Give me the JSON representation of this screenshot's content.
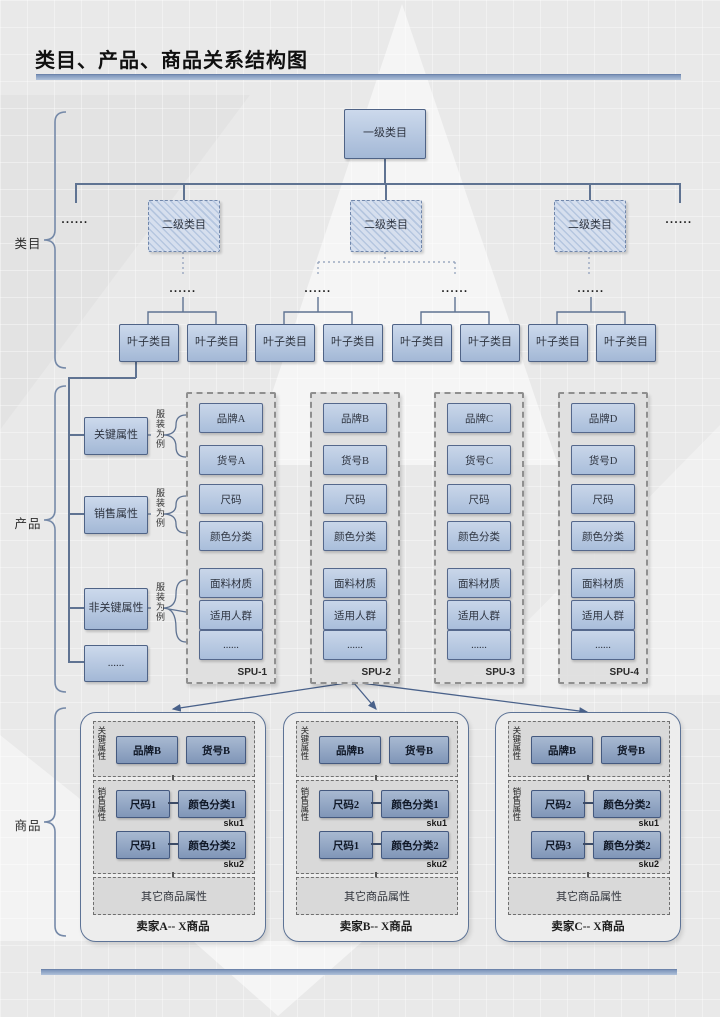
{
  "title": "类目、产品、商品关系结构图",
  "ellipsis": "......",
  "category": {
    "label": "类目",
    "root": "一级类目",
    "level2": [
      "二级类目",
      "二级类目",
      "二级类目"
    ],
    "leaves": [
      "叶子类目",
      "叶子类目",
      "叶子类目",
      "叶子类目",
      "叶子类目",
      "叶子类目",
      "叶子类目",
      "叶子类目"
    ]
  },
  "product": {
    "label": "产品",
    "example_note": "服装为例",
    "attr_groups": [
      {
        "label": "关键属性"
      },
      {
        "label": "销售属性"
      },
      {
        "label": "非关键属性"
      },
      {
        "label": "......"
      }
    ],
    "spus": [
      {
        "name": "SPU-1",
        "items": [
          "品牌A",
          "货号A",
          "尺码",
          "颜色分类",
          "面料材质",
          "适用人群",
          "......"
        ]
      },
      {
        "name": "SPU-2",
        "items": [
          "品牌B",
          "货号B",
          "尺码",
          "颜色分类",
          "面料材质",
          "适用人群",
          "......"
        ]
      },
      {
        "name": "SPU-3",
        "items": [
          "品牌C",
          "货号C",
          "尺码",
          "颜色分类",
          "面料材质",
          "适用人群",
          "......"
        ]
      },
      {
        "name": "SPU-4",
        "items": [
          "品牌D",
          "货号D",
          "尺码",
          "颜色分类",
          "面料材质",
          "适用人群",
          "......"
        ]
      }
    ]
  },
  "goods": {
    "label": "商品",
    "sellers": [
      {
        "caption": "卖家A-- X商品",
        "key_label": "关键属性",
        "brand": "品牌B",
        "item_no": "货号B",
        "sales_label": "销售属性",
        "skus": [
          {
            "size": "尺码1",
            "color": "颜色分类1",
            "tag": "sku1"
          },
          {
            "size": "尺码1",
            "color": "颜色分类2",
            "tag": "sku2"
          }
        ],
        "other": "其它商品属性"
      },
      {
        "caption": "卖家B-- X商品",
        "key_label": "关键属性",
        "brand": "品牌B",
        "item_no": "货号B",
        "sales_label": "销售属性",
        "skus": [
          {
            "size": "尺码2",
            "color": "颜色分类1",
            "tag": "sku1"
          },
          {
            "size": "尺码1",
            "color": "颜色分类2",
            "tag": "sku2"
          }
        ],
        "other": "其它商品属性"
      },
      {
        "caption": "卖家C-- X商品",
        "key_label": "关键属性",
        "brand": "品牌B",
        "item_no": "货号B",
        "sales_label": "销售属性",
        "skus": [
          {
            "size": "尺码2",
            "color": "颜色分类2",
            "tag": "sku1"
          },
          {
            "size": "尺码3",
            "color": "颜色分类2",
            "tag": "sku2"
          }
        ],
        "other": "其它商品属性"
      }
    ]
  },
  "colors": {
    "accent_bar": "#8ba1c6",
    "box_border": "#4f6386",
    "box_fill_top": "#ccd9ec",
    "box_fill_bottom": "#a3b8d6",
    "seller_box_fill": "#8096b8",
    "line": "#5f7392"
  }
}
